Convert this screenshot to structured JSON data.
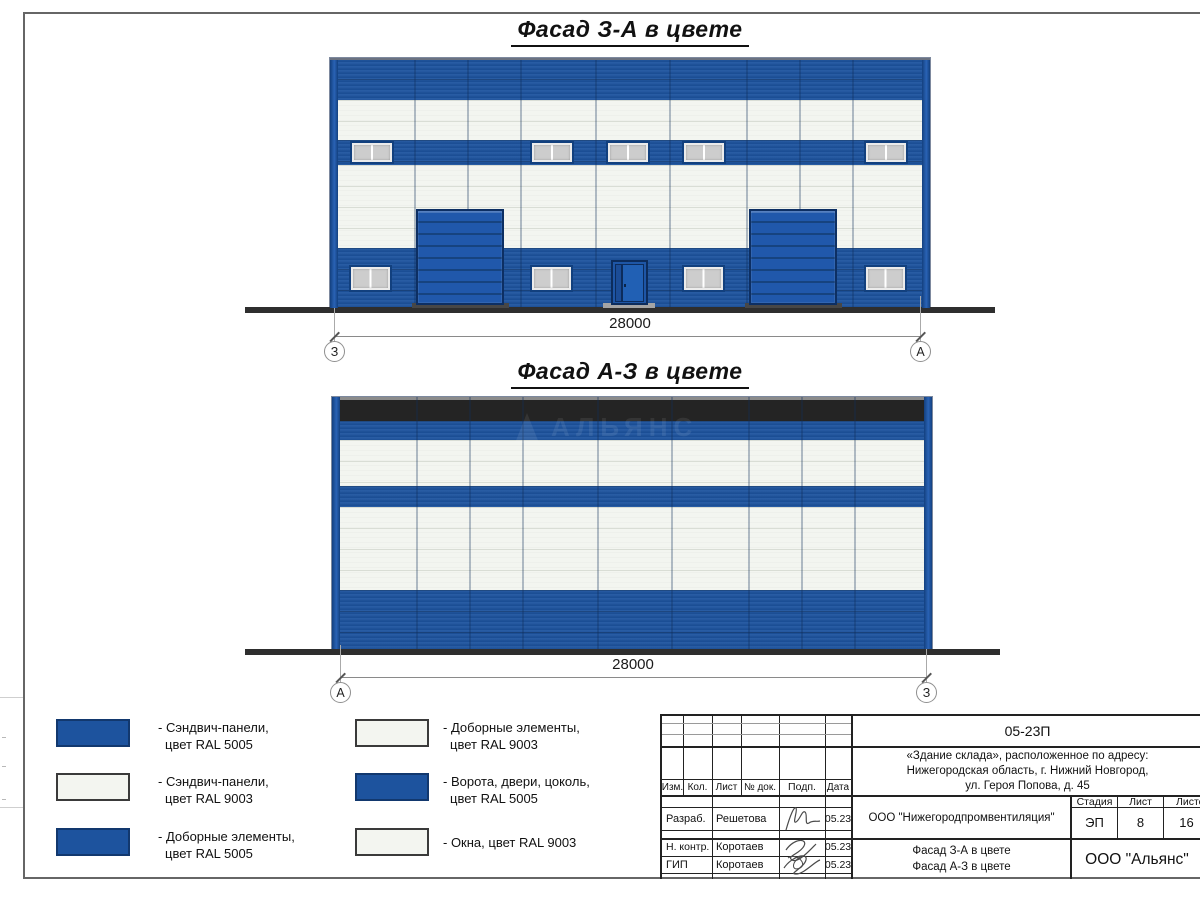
{
  "titles": {
    "facade_za": "Фасад З-А в цвете",
    "facade_az": "Фасад А-З в цвете"
  },
  "dimensions": {
    "za": {
      "value": "28000",
      "left_axis": "З",
      "right_axis": "А"
    },
    "az": {
      "value": "28000",
      "left_axis": "А",
      "right_axis": "З"
    }
  },
  "watermark": {
    "text": "АЛЬЯНС"
  },
  "legend": [
    {
      "color": "#1d539e",
      "line1": "- Сэндвич-панели,",
      "line2": "цвет RAL 5005"
    },
    {
      "color": "#f3f5f0",
      "line1": "- Сэндвич-панели,",
      "line2": "цвет RAL 9003"
    },
    {
      "color": "#1d539e",
      "line1": "- Доборные элементы,",
      "line2": "цвет RAL 5005"
    },
    {
      "color": "#f3f5f0",
      "line1": "- Доборные элементы,",
      "line2": "цвет RAL 9003"
    },
    {
      "color": "#1d539e",
      "line1": "- Ворота, двери, цоколь,",
      "line2": "цвет RAL 5005"
    },
    {
      "color": "#f3f5f0",
      "line1": "- Окна, цвет RAL 9003",
      "line2": ""
    }
  ],
  "title_block": {
    "doc_number": "05-23П",
    "object_line1": "«Здание склада», расположенное по адресу:",
    "object_line2": "Нижегородская область, г. Нижний Новгород,",
    "object_line3": "ул. Героя Попова, д. 45",
    "columns": {
      "izm": "Изм.",
      "kol": "Кол.",
      "list": "Лист",
      "doc": "№ док.",
      "podp": "Подп.",
      "data": "Дата"
    },
    "rows": [
      {
        "role": "Разраб.",
        "name": "Решетова",
        "date": "05.23"
      },
      {
        "role": "Н. контр.",
        "name": "Коротаев",
        "date": "05.23"
      },
      {
        "role": "ГИП",
        "name": "Коротаев",
        "date": "05.23"
      }
    ],
    "org": "ООО \"Нижегородпромвентиляция\"",
    "stage": {
      "h1": "Стадия",
      "h2": "Лист",
      "h3": "Листов",
      "v1": "ЭП",
      "v2": "8",
      "v3": "16"
    },
    "sheet_title_line1": "Фасад З-А в цвете",
    "sheet_title_line2": "Фасад А-З в цвете",
    "company": "ООО \"Альянс\""
  },
  "colors": {
    "ral5005": "#1d539e",
    "ral9003": "#f3f5f0",
    "dark_parapet": "#242424",
    "ground": "#2e2e2e"
  }
}
